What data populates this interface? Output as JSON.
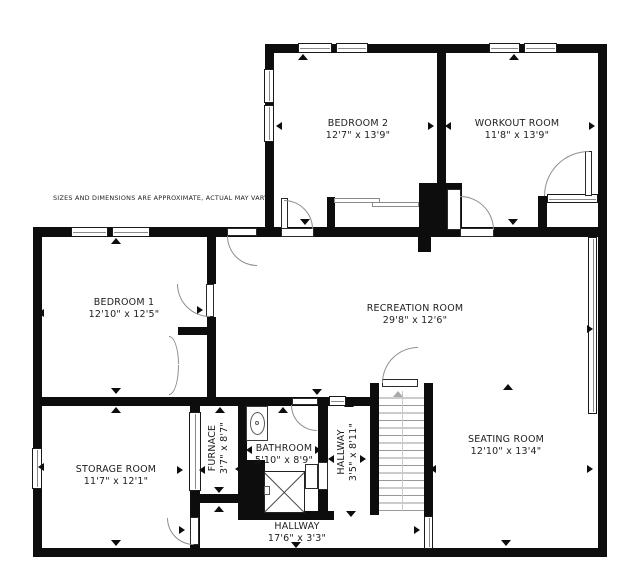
{
  "disclaimer": "SIZES AND DIMENSIONS ARE APPROXIMATE, ACTUAL MAY VARY.",
  "floorplan": {
    "colors": {
      "wall": "#0d0d0d",
      "text": "#1e1e1e",
      "door_arc": "#8e8e8e",
      "stair_tread": "#999999"
    },
    "rooms": [
      {
        "id": "bedroom-2",
        "name": "BEDROOM 2",
        "dims": "12'7\" x 13'9\"",
        "cx": 358,
        "cy": 130,
        "rotated": false
      },
      {
        "id": "workout-room",
        "name": "WORKOUT ROOM",
        "dims": "11'8\" x 13'9\"",
        "cx": 517,
        "cy": 130,
        "rotated": false
      },
      {
        "id": "bedroom-1",
        "name": "BEDROOM 1",
        "dims": "12'10\" x 12'5\"",
        "cx": 124,
        "cy": 309,
        "rotated": false
      },
      {
        "id": "recreation-room",
        "name": "RECREATION ROOM",
        "dims": "29'8\" x 12'6\"",
        "cx": 415,
        "cy": 315,
        "rotated": false
      },
      {
        "id": "storage-room",
        "name": "STORAGE ROOM",
        "dims": "11'7\" x 12'1\"",
        "cx": 116,
        "cy": 476,
        "rotated": false
      },
      {
        "id": "furnace",
        "name": "FURNACE",
        "dims": "3'7\" x 8'7\"",
        "cx": 219,
        "cy": 448,
        "rotated": true
      },
      {
        "id": "bathroom",
        "name": "BATHROOM",
        "dims": "5'10\" x 8'9\"",
        "cx": 284,
        "cy": 455,
        "rotated": false
      },
      {
        "id": "hallway-vertical",
        "name": "HALLWAY",
        "dims": "3'5\" x 8'11\"",
        "cx": 348,
        "cy": 452,
        "rotated": true
      },
      {
        "id": "seating-room",
        "name": "SEATING ROOM",
        "dims": "12'10\" x 13'4\"",
        "cx": 506,
        "cy": 446,
        "rotated": false
      },
      {
        "id": "hallway",
        "name": "HALLWAY",
        "dims": "17'6\" x 3'3\"",
        "cx": 297,
        "cy": 533,
        "rotated": false
      }
    ],
    "walls": [
      [
        265,
        44,
        342,
        9
      ],
      [
        265,
        44,
        9,
        193
      ],
      [
        598,
        44,
        9,
        513
      ],
      [
        33,
        227,
        574,
        10
      ],
      [
        33,
        228,
        9,
        329
      ],
      [
        33,
        548,
        574,
        9
      ],
      [
        437,
        53,
        9,
        131
      ],
      [
        419,
        183,
        43,
        52
      ],
      [
        418,
        235,
        13,
        17
      ],
      [
        327,
        197,
        8,
        31
      ],
      [
        538,
        196,
        9,
        36
      ],
      [
        207,
        237,
        9,
        47
      ],
      [
        207,
        317,
        9,
        89
      ],
      [
        178,
        327,
        37,
        8
      ],
      [
        33,
        397,
        183,
        9
      ],
      [
        216,
        397,
        156,
        9
      ],
      [
        190,
        406,
        10,
        151
      ],
      [
        190,
        494,
        57,
        9
      ],
      [
        238,
        406,
        9,
        60
      ],
      [
        238,
        460,
        27,
        55
      ],
      [
        318,
        406,
        10,
        106
      ],
      [
        238,
        511,
        96,
        9
      ],
      [
        370,
        383,
        9,
        132
      ],
      [
        424,
        383,
        9,
        174
      ]
    ],
    "windows": [
      [
        298,
        43,
        34,
        10,
        "h"
      ],
      [
        336,
        43,
        32,
        10,
        "h"
      ],
      [
        489,
        43,
        31,
        10,
        "h"
      ],
      [
        524,
        43,
        33,
        10,
        "h"
      ],
      [
        264,
        69,
        10,
        34,
        "v"
      ],
      [
        264,
        105,
        10,
        37,
        "v"
      ],
      [
        71,
        227,
        37,
        10,
        "h"
      ],
      [
        112,
        227,
        38,
        10,
        "h"
      ],
      [
        32,
        448,
        10,
        41,
        "v"
      ],
      [
        588,
        237,
        9,
        177,
        "v"
      ],
      [
        424,
        516,
        9,
        33,
        "v"
      ],
      [
        329,
        396,
        17,
        10,
        "h"
      ],
      [
        189,
        412,
        12,
        79,
        "v"
      ],
      [
        547,
        194,
        51,
        9,
        "h"
      ]
    ],
    "sliders": [
      [
        334,
        198,
        46,
        5
      ],
      [
        372,
        202,
        47,
        5
      ]
    ],
    "door_leaves": [
      [
        281,
        228,
        33,
        9
      ],
      [
        281,
        198,
        7,
        31
      ],
      [
        227,
        228,
        30,
        8
      ],
      [
        460,
        228,
        34,
        9
      ],
      [
        447,
        189,
        14,
        41
      ],
      [
        585,
        151,
        7,
        45
      ],
      [
        206,
        284,
        8,
        33
      ],
      [
        292,
        398,
        26,
        7
      ],
      [
        318,
        462,
        10,
        28
      ],
      [
        305,
        464,
        13,
        25
      ],
      [
        190,
        517,
        9,
        28
      ],
      [
        382,
        379,
        36,
        8
      ]
    ],
    "door_arcs": [
      [
        284,
        200,
        29,
        29,
        "tr"
      ],
      [
        227,
        236,
        30,
        30,
        "bl"
      ],
      [
        460,
        196,
        34,
        34,
        "tr"
      ],
      [
        544,
        151,
        45,
        45,
        "tl"
      ],
      [
        177,
        284,
        33,
        33,
        "bl"
      ],
      [
        291,
        405,
        26,
        26,
        "bl"
      ],
      [
        167,
        518,
        27,
        27,
        "bl"
      ],
      [
        382,
        347,
        36,
        36,
        "tl"
      ],
      [
        169,
        336,
        10,
        28,
        "tr"
      ],
      [
        169,
        365,
        10,
        30,
        "br"
      ]
    ],
    "arrows": [
      [
        303,
        57,
        "u"
      ],
      [
        514,
        57,
        "u"
      ],
      [
        281,
        126,
        "l"
      ],
      [
        433,
        126,
        "r"
      ],
      [
        450,
        126,
        "l"
      ],
      [
        594,
        126,
        "r"
      ],
      [
        305,
        222,
        "d"
      ],
      [
        513,
        222,
        "d"
      ],
      [
        116,
        241,
        "u"
      ],
      [
        43,
        313,
        "l"
      ],
      [
        202,
        310,
        "r"
      ],
      [
        116,
        391,
        "d"
      ],
      [
        317,
        392,
        "d"
      ],
      [
        508,
        387,
        "u"
      ],
      [
        592,
        329,
        "r"
      ],
      [
        116,
        410,
        "u"
      ],
      [
        220,
        410,
        "u"
      ],
      [
        283,
        410,
        "u"
      ],
      [
        43,
        467,
        "l"
      ],
      [
        182,
        470,
        "r"
      ],
      [
        204,
        470,
        "l"
      ],
      [
        240,
        469,
        "l"
      ],
      [
        251,
        450,
        "l"
      ],
      [
        320,
        450,
        "r"
      ],
      [
        333,
        459,
        "l"
      ],
      [
        365,
        459,
        "r"
      ],
      [
        349,
        404,
        "u"
      ],
      [
        351,
        514,
        "d"
      ],
      [
        219,
        490,
        "d"
      ],
      [
        219,
        509,
        "u"
      ],
      [
        116,
        543,
        "d"
      ],
      [
        296,
        545,
        "d"
      ],
      [
        419,
        530,
        "r"
      ],
      [
        184,
        530,
        "r"
      ],
      [
        435,
        469,
        "l"
      ],
      [
        592,
        469,
        "r"
      ],
      [
        506,
        543,
        "d"
      ]
    ],
    "stairs": {
      "x": 379,
      "y": 391,
      "w": 45,
      "h": 120,
      "treads": 16,
      "arrow": [
        398,
        394
      ]
    },
    "fixtures": {
      "vanity": [
        246,
        406,
        22,
        35
      ],
      "sink": [
        250,
        412,
        15,
        23
      ],
      "sink_dot": [
        255,
        421,
        4,
        4
      ],
      "shower": [
        264,
        471,
        41,
        42
      ],
      "shower_head": [
        264,
        486,
        6,
        9
      ]
    }
  }
}
